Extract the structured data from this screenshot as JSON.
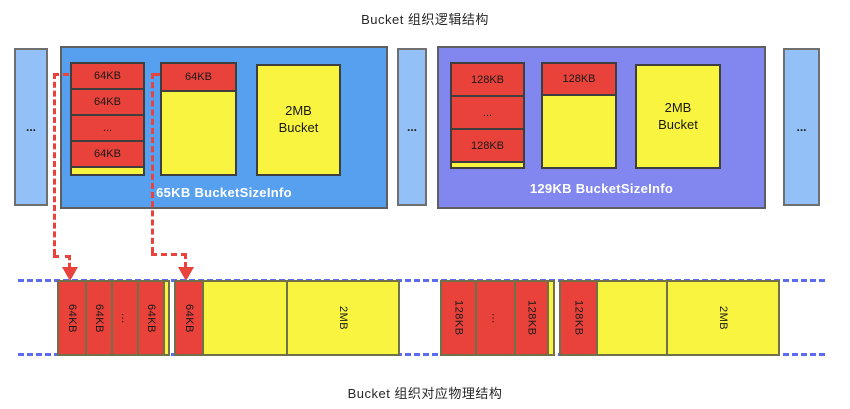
{
  "titles": {
    "top": "Bucket 组织逻辑结构",
    "bottom": "Bucket 组织对应物理结构"
  },
  "logical": {
    "left_ellipsis": "...",
    "middle_ellipsis": "...",
    "right_ellipsis": "...",
    "left_bucket": {
      "label": "65KB BucketSizeInfo",
      "stack_cells": [
        "64KB",
        "64KB",
        "...",
        "64KB"
      ],
      "partial_block_label": "64KB",
      "free_bucket_line1": "2MB",
      "free_bucket_line2": "Bucket"
    },
    "right_bucket": {
      "label": "129KB BucketSizeInfo",
      "stack_cells": [
        "128KB",
        "...",
        "128KB"
      ],
      "partial_block_label": "128KB",
      "free_bucket_line1": "2MB",
      "free_bucket_line2": "Bucket"
    }
  },
  "physical": {
    "left_bar": {
      "used_cells": [
        "64KB",
        "64KB",
        "...",
        "64KB"
      ],
      "partial_cell": "64KB",
      "free_cell": "2MB"
    },
    "right_bar": {
      "used_cells": [
        "128KB",
        "...",
        "128KB"
      ],
      "partial_cell": "128KB",
      "free_cell": "2MB"
    }
  },
  "colors": {
    "container_blue": "#57a0f0",
    "container_purple": "#8287f0",
    "side_box_blue": "#93c1f7",
    "block_red": "#e8423a",
    "block_yellow": "#f8f440",
    "dashed_blue": "#5b6cf0",
    "dashed_red": "#e8433c"
  }
}
